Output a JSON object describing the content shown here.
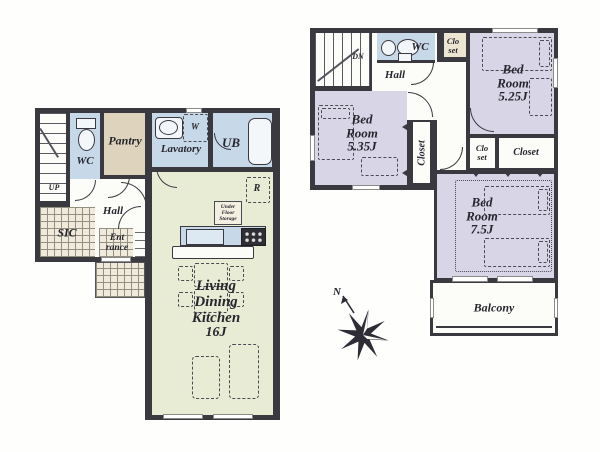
{
  "colors": {
    "wall": "#3b3940",
    "roomwhite": "#fcfcf9",
    "waterblue": "#c7d8e8",
    "bedlav": "#d8d5e7",
    "ldkgreen": "#e9ecd4",
    "pantrytan": "#ded3bd",
    "tilebg": "#efeadb",
    "tileline": "#93907f",
    "closetbeige": "#ece5d2",
    "ink": "#26262e"
  },
  "floor1": {
    "stairs": "UP",
    "wc": "WC",
    "pantry": "Pantry",
    "lavatory": "Lavatory",
    "washer": "W",
    "ub": "UB",
    "hall": "Hall",
    "sic": "SIC",
    "entrance": [
      "Ent",
      "rance"
    ],
    "fridge": "R",
    "under_floor_storage": [
      "Under",
      "Floor",
      "Storage"
    ],
    "ldk": [
      "Living",
      "Dining",
      "Kitchen",
      "16J"
    ]
  },
  "floor2": {
    "stairs": "DN",
    "hall": "Hall",
    "wc": "WC",
    "closet_top": [
      "Clo",
      "set"
    ],
    "bedroom_525": [
      "Bed",
      "Room",
      "5.25J"
    ],
    "bedroom_535": [
      "Bed",
      "Room",
      "5.35J"
    ],
    "closet_side": "Closet",
    "closet_small": [
      "Clo",
      "set"
    ],
    "closet_wide": "Closet",
    "bedroom_75": [
      "Bed",
      "Room",
      "7.5J"
    ],
    "balcony": "Balcony"
  },
  "compass": {
    "north": "N"
  }
}
